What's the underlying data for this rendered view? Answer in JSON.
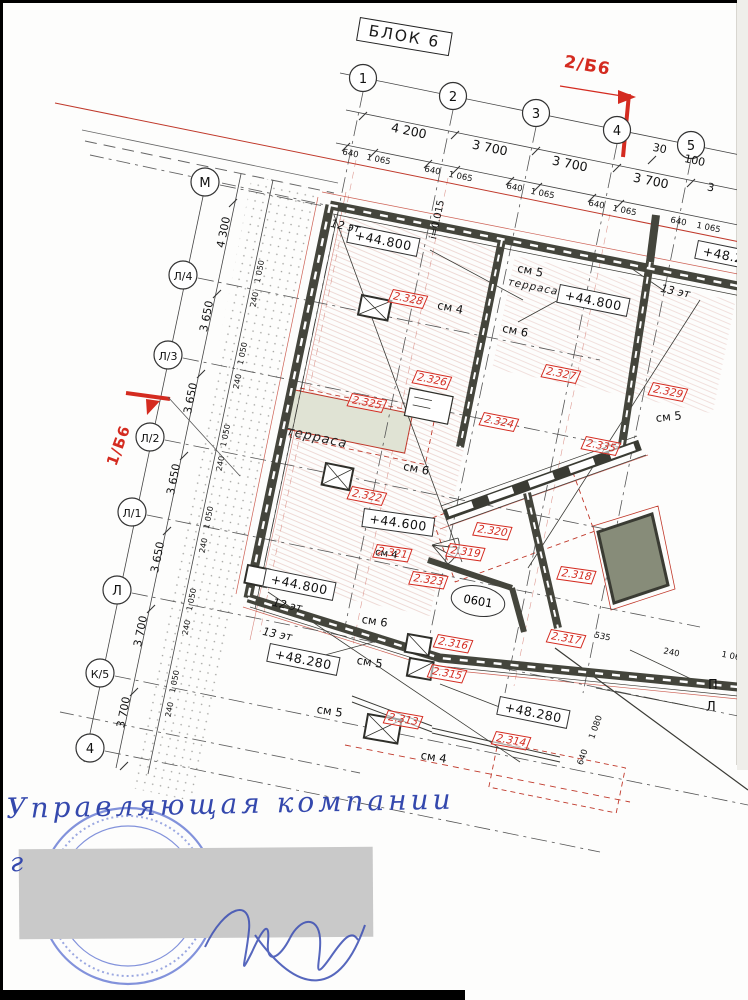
{
  "title": "БЛОК 6",
  "sections": {
    "left": "1/Б6",
    "right": "2/Б6"
  },
  "axes": {
    "top": [
      "1",
      "2",
      "3",
      "4",
      "5"
    ],
    "left": [
      "М",
      "Л/4",
      "Л/3",
      "Л/2",
      "Л/1",
      "Л",
      "К/5",
      "4"
    ]
  },
  "dims": {
    "top": [
      "4 200",
      "3 700",
      "3 700",
      "3 700"
    ],
    "near5": [
      "30",
      "100",
      "3"
    ],
    "sub": {
      "a": "640",
      "b": "1 065"
    },
    "left": [
      "4 300",
      "3 650",
      "3 650",
      "3 650",
      "3 650",
      "3 700",
      "3 700"
    ],
    "leftsub": {
      "a": "1 050",
      "b": "240"
    },
    "right": [
      "535",
      "240",
      "1 065",
      "1 080",
      "640"
    ]
  },
  "details": {
    "d13": "2.313",
    "d14": "2.314",
    "d15": "2.315",
    "d16": "2.316",
    "d17": "2.317",
    "d18": "2.318",
    "d19": "2.319",
    "d20": "2.320",
    "d21": "2.321",
    "d22": "2.322",
    "d23": "2.323",
    "d24": "2.324",
    "d25": "2.325",
    "d26": "2.326",
    "d27": "2.327",
    "d28": "2.328",
    "d29": "2.329",
    "d35": "2.335"
  },
  "levels": {
    "v448a": "+44.800",
    "v448b": "+44.800",
    "v448c": "+44.800",
    "v446": "+44.600",
    "v482a": "+48.280",
    "v482b": "+48.280",
    "v482c": "+48.280"
  },
  "floors": {
    "f12a": "12 эт",
    "f12b": "12 эт",
    "f13a": "13 эт",
    "f13b": "13 эт"
  },
  "notes": {
    "sm4": "см 4",
    "sm5": "см 5",
    "sm6": "см 6",
    "terrace": "терраса",
    "slope": "i=0.015",
    "room": "0601",
    "p": "П",
    "l": "Л"
  },
  "handwriting": {
    "line1": "Управляющая компании",
    "line2": "г"
  }
}
